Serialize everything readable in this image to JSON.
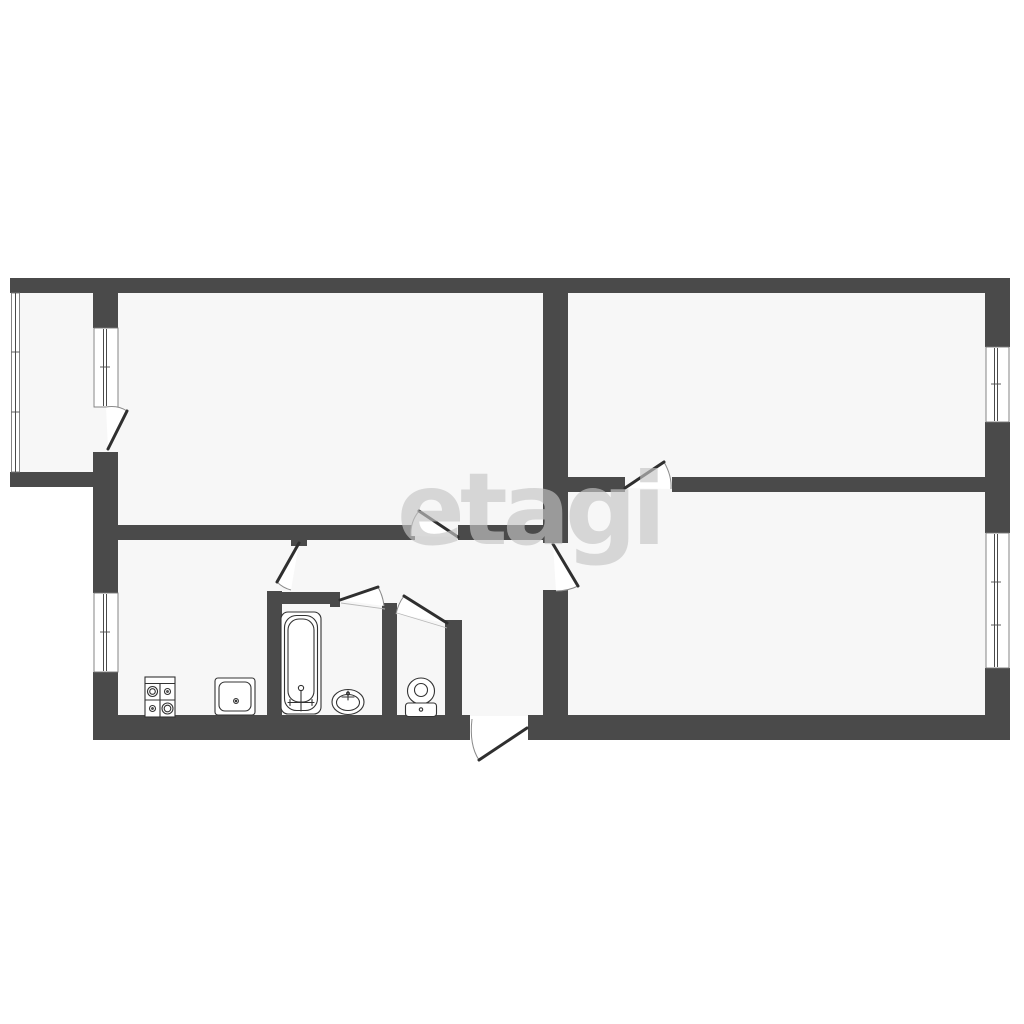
{
  "watermark": {
    "text": "etagi"
  },
  "colors": {
    "bg": "#ffffff",
    "wall": "#4a4a4a",
    "room": "#f7f7f7",
    "line": "#333333",
    "leaf": "#2f2f2f",
    "arc": "#8a8a8a",
    "wm": "rgba(196,196,196,0.65)"
  },
  "plan": {
    "kind": "apartment-floor-plan",
    "window_count": 5,
    "door_count": 8,
    "fixtures": [
      "stove-icon",
      "kitchen-sink-icon",
      "bathtub-icon",
      "washbasin-icon",
      "toilet-icon"
    ]
  }
}
